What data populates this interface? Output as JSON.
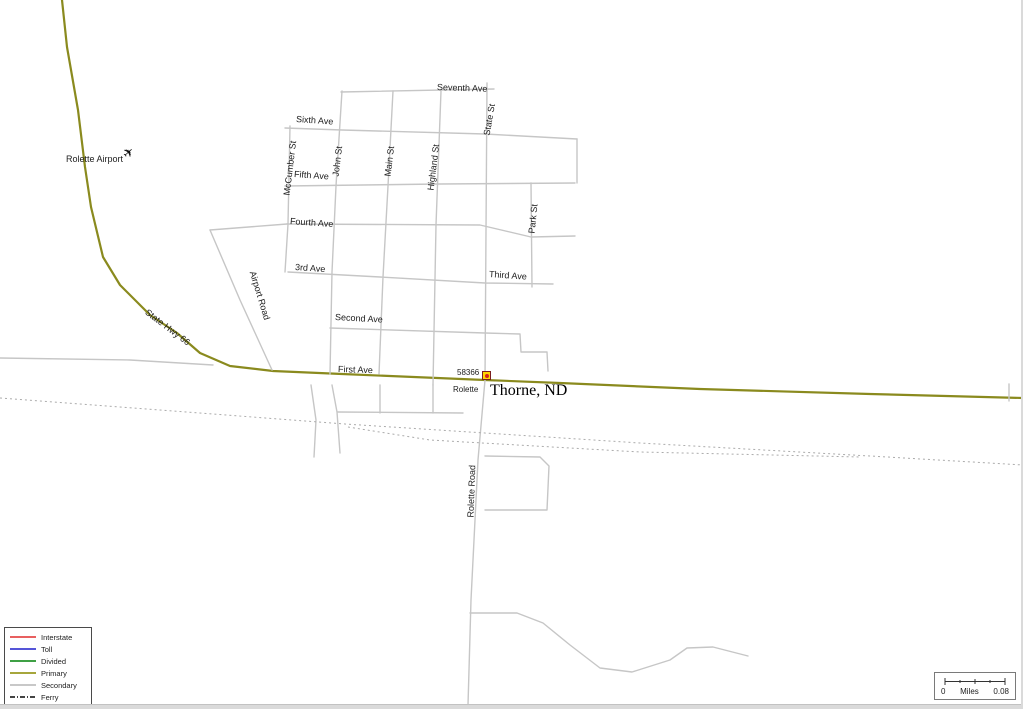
{
  "place": {
    "name": "Thorne, ND",
    "zip": "58366",
    "town": "Rolette",
    "airport": "Rolette Airport",
    "highway": "State Hwy 66"
  },
  "colors": {
    "background": "#ffffff",
    "primary_road": "#8a8a1e",
    "secondary_road": "#c6c6c6",
    "railroad": "#ababab",
    "interstate": "#e86060",
    "toll": "#5555d8",
    "divided": "#3fa045",
    "primary": "#a6a63c",
    "secondary": "#c8c8c8",
    "ferry": "#444444"
  },
  "legend": {
    "items": [
      {
        "label": "Interstate",
        "color": "#e86060",
        "style": "solid"
      },
      {
        "label": "Toll",
        "color": "#5555d8",
        "style": "solid"
      },
      {
        "label": "Divided",
        "color": "#3fa045",
        "style": "solid"
      },
      {
        "label": "Primary",
        "color": "#a6a63c",
        "style": "solid"
      },
      {
        "label": "Secondary",
        "color": "#c8c8c8",
        "style": "solid"
      },
      {
        "label": "Ferry",
        "color": "#444444",
        "style": "dashdot"
      }
    ]
  },
  "scale_bar": {
    "start": "0",
    "unit": "Miles",
    "end": "0.08"
  },
  "map": {
    "icons": {
      "airport_glyph": "✈"
    },
    "labels": [
      {
        "name": "rolette-airport",
        "text": "Rolette Airport",
        "x": 66,
        "y": 155,
        "rot": 0,
        "size": 9
      },
      {
        "name": "state-hwy-66",
        "text": "State Hwy 66",
        "x": 146,
        "y": 307,
        "rot": 37,
        "size": 9
      },
      {
        "name": "seventh-ave",
        "text": "Seventh Ave",
        "x": 437,
        "y": 83,
        "rot": 2,
        "size": 9
      },
      {
        "name": "sixth-ave",
        "text": "Sixth Ave",
        "x": 296,
        "y": 115,
        "rot": 4,
        "size": 9
      },
      {
        "name": "fifth-ave",
        "text": "Fifth Ave",
        "x": 294,
        "y": 170,
        "rot": 4,
        "size": 9
      },
      {
        "name": "fourth-ave",
        "text": "Fourth Ave",
        "x": 290,
        "y": 217,
        "rot": 4,
        "size": 9
      },
      {
        "name": "3rd-ave",
        "text": "3rd Ave",
        "x": 295,
        "y": 263,
        "rot": 4,
        "size": 9
      },
      {
        "name": "third-ave",
        "text": "Third Ave",
        "x": 489,
        "y": 270,
        "rot": 4,
        "size": 9
      },
      {
        "name": "second-ave",
        "text": "Second Ave",
        "x": 335,
        "y": 313,
        "rot": 3,
        "size": 9
      },
      {
        "name": "first-ave",
        "text": "First Ave",
        "x": 338,
        "y": 365,
        "rot": 2,
        "size": 9
      },
      {
        "name": "mccumber-st",
        "text": "McCumber St",
        "x": 287,
        "y": 191,
        "rot": -83,
        "size": 9
      },
      {
        "name": "john-st",
        "text": "John St",
        "x": 336,
        "y": 172,
        "rot": -83,
        "size": 9
      },
      {
        "name": "main-st",
        "text": "Main St",
        "x": 388,
        "y": 172,
        "rot": -83,
        "size": 9
      },
      {
        "name": "highland-st",
        "text": "Highland St",
        "x": 431,
        "y": 186,
        "rot": -83,
        "size": 9
      },
      {
        "name": "state-st",
        "text": "State St",
        "x": 487,
        "y": 131,
        "rot": -80,
        "size": 9
      },
      {
        "name": "park-st",
        "text": "Park St",
        "x": 532,
        "y": 229,
        "rot": -84,
        "size": 9
      },
      {
        "name": "airport-road",
        "text": "Airport Road",
        "x": 252,
        "y": 267,
        "rot": 73,
        "size": 9
      },
      {
        "name": "rolette-road",
        "text": "Rolette Road",
        "x": 471,
        "y": 513,
        "rot": -88,
        "size": 9
      },
      {
        "name": "zip-code",
        "text": "58366",
        "x": 457,
        "y": 369,
        "rot": 0,
        "size": 8
      },
      {
        "name": "town-name",
        "text": "Rolette",
        "x": 453,
        "y": 386,
        "rot": 0,
        "size": 8
      }
    ],
    "roads": [
      {
        "name": "state-hwy-66",
        "type": "primary",
        "points": [
          [
            62,
            0
          ],
          [
            67,
            47
          ],
          [
            78,
            110
          ],
          [
            85,
            167
          ],
          [
            91,
            207
          ],
          [
            103,
            257
          ],
          [
            120,
            285
          ],
          [
            150,
            315
          ],
          [
            177,
            333
          ],
          [
            200,
            353
          ],
          [
            230,
            366
          ],
          [
            273,
            371
          ],
          [
            342,
            374
          ],
          [
            485,
            380
          ],
          [
            560,
            383
          ],
          [
            700,
            389
          ],
          [
            870,
            394
          ],
          [
            1023,
            398
          ]
        ]
      },
      {
        "name": "west-frontage-road",
        "type": "secondary",
        "points": [
          [
            0,
            358
          ],
          [
            130,
            360
          ],
          [
            213,
            365
          ]
        ]
      },
      {
        "name": "airport-road",
        "type": "secondary",
        "points": [
          [
            210,
            230
          ],
          [
            240,
            300
          ],
          [
            272,
            370
          ]
        ]
      },
      {
        "name": "fourth-ave-west",
        "type": "secondary",
        "points": [
          [
            210,
            230
          ],
          [
            287,
            224
          ]
        ]
      },
      {
        "name": "seventh-ave",
        "type": "secondary",
        "points": [
          [
            341,
            92
          ],
          [
            494,
            89
          ]
        ]
      },
      {
        "name": "sixth-ave",
        "type": "secondary",
        "points": [
          [
            285,
            128
          ],
          [
            342,
            130
          ],
          [
            485,
            134
          ],
          [
            577,
            139
          ]
        ]
      },
      {
        "name": "sixth-fifth-connector",
        "type": "secondary",
        "points": [
          [
            577,
            139
          ],
          [
            577,
            183
          ]
        ]
      },
      {
        "name": "fifth-ave",
        "type": "secondary",
        "points": [
          [
            285,
            186
          ],
          [
            440,
            184
          ],
          [
            575,
            183
          ]
        ]
      },
      {
        "name": "fourth-ave",
        "type": "secondary",
        "points": [
          [
            287,
            224
          ],
          [
            480,
            225
          ],
          [
            531,
            237
          ],
          [
            575,
            236
          ]
        ]
      },
      {
        "name": "third-ave",
        "type": "secondary",
        "points": [
          [
            288,
            272
          ],
          [
            380,
            277
          ],
          [
            485,
            283
          ],
          [
            553,
            284
          ]
        ]
      },
      {
        "name": "second-ave",
        "type": "secondary",
        "points": [
          [
            330,
            328
          ],
          [
            485,
            333
          ],
          [
            520,
            334
          ],
          [
            521,
            352
          ],
          [
            547,
            352
          ],
          [
            548,
            371
          ]
        ]
      },
      {
        "name": "mccumber-st",
        "type": "secondary",
        "points": [
          [
            290,
            126
          ],
          [
            288,
            224
          ],
          [
            285,
            272
          ]
        ]
      },
      {
        "name": "john-st",
        "type": "secondary",
        "points": [
          [
            342,
            91
          ],
          [
            336,
            186
          ],
          [
            332,
            272
          ],
          [
            330,
            374
          ]
        ]
      },
      {
        "name": "main-st",
        "type": "secondary",
        "points": [
          [
            393,
            91
          ],
          [
            388,
            186
          ],
          [
            383,
            277
          ],
          [
            379,
            374
          ]
        ]
      },
      {
        "name": "highland-st",
        "type": "secondary",
        "points": [
          [
            441,
            91
          ],
          [
            436,
            225
          ],
          [
            433,
            385
          ]
        ]
      },
      {
        "name": "state-st",
        "type": "secondary",
        "points": [
          [
            487,
            83
          ],
          [
            485,
            380
          ]
        ]
      },
      {
        "name": "rolette-road",
        "type": "secondary",
        "points": [
          [
            485,
            380
          ],
          [
            478,
            460
          ],
          [
            471,
            600
          ],
          [
            468,
            705
          ]
        ]
      },
      {
        "name": "park-st",
        "type": "secondary",
        "points": [
          [
            531,
            183
          ],
          [
            532,
            287
          ]
        ]
      },
      {
        "name": "south-lane-west",
        "type": "secondary",
        "points": [
          [
            311,
            385
          ],
          [
            316,
            420
          ],
          [
            314,
            457
          ]
        ]
      },
      {
        "name": "south-lane-east",
        "type": "secondary",
        "points": [
          [
            332,
            385
          ],
          [
            337,
            412
          ],
          [
            340,
            453
          ]
        ]
      },
      {
        "name": "main-st-south",
        "type": "secondary",
        "points": [
          [
            380,
            385
          ],
          [
            380,
            413
          ]
        ]
      },
      {
        "name": "highland-st-south",
        "type": "secondary",
        "points": [
          [
            433,
            385
          ],
          [
            433,
            413
          ]
        ]
      },
      {
        "name": "south-alley",
        "type": "secondary",
        "points": [
          [
            338,
            412
          ],
          [
            463,
            413
          ]
        ]
      },
      {
        "name": "east-loop",
        "type": "secondary",
        "points": [
          [
            485,
            456
          ],
          [
            540,
            457
          ],
          [
            549,
            466
          ],
          [
            547,
            510
          ],
          [
            485,
            510
          ]
        ]
      },
      {
        "name": "south-branch-road",
        "type": "secondary",
        "points": [
          [
            470,
            613
          ],
          [
            517,
            613
          ],
          [
            543,
            623
          ],
          [
            570,
            645
          ],
          [
            600,
            668
          ],
          [
            632,
            672
          ],
          [
            670,
            660
          ],
          [
            687,
            648
          ],
          [
            713,
            647
          ],
          [
            748,
            656
          ]
        ]
      },
      {
        "name": "east-crossroad",
        "type": "secondary",
        "points": [
          [
            1009,
            384
          ],
          [
            1009,
            401
          ]
        ]
      },
      {
        "name": "railroad-main",
        "type": "rail",
        "points": [
          [
            0,
            398
          ],
          [
            345,
            424
          ],
          [
            640,
            443
          ],
          [
            870,
            456
          ],
          [
            1023,
            465
          ]
        ]
      },
      {
        "name": "railroad-siding",
        "type": "rail",
        "points": [
          [
            348,
            427
          ],
          [
            430,
            440
          ],
          [
            640,
            452
          ],
          [
            860,
            457
          ]
        ]
      }
    ]
  }
}
